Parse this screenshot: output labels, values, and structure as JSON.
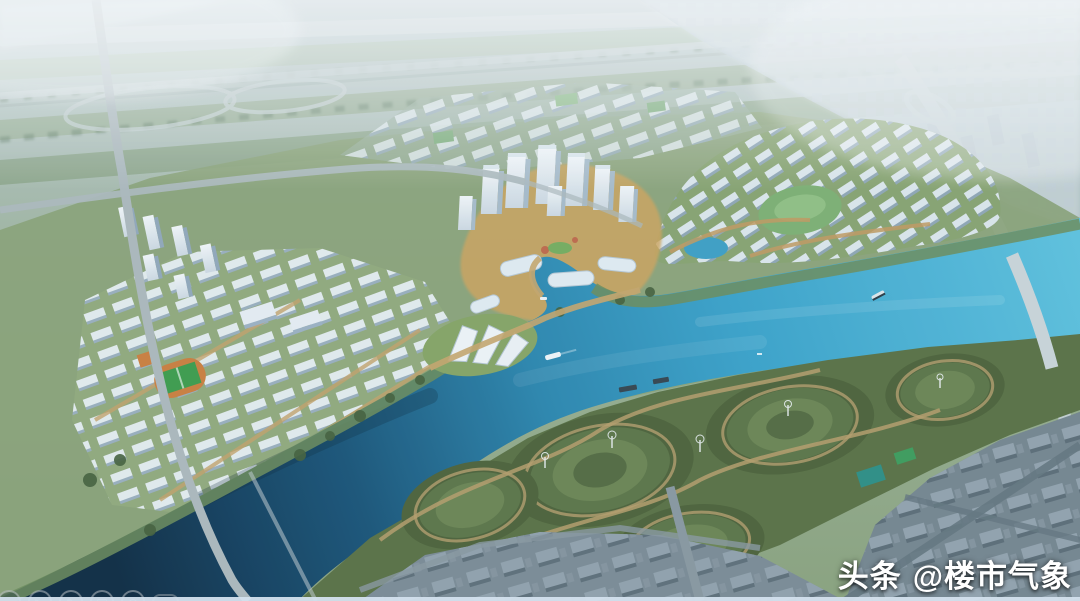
{
  "scene": {
    "description": "Aerial rendering of a riverside new-town masterplan: white residential clusters and a CBD tower group on the north bank, a wide cyan river with boats, a terraced green park and existing grey city blocks on the south bank, hazy farmland and distant city on the horizon",
    "palette": {
      "haze": "#c3cfd4",
      "distant_fields": "#9cb199",
      "river_bright": "#4fb5d8",
      "river_dark": "#102c42",
      "park_green": "#5b7144",
      "building_white": "#eef3f6",
      "plaza_tan": "#d2a55c",
      "city_grey": "#8c9ba5",
      "pitch_green": "#3f9c4b",
      "track_orange": "#cd7f3e"
    },
    "features": [
      "distant-farmland",
      "railway-corridor",
      "highway-interchange",
      "left-residential-cluster",
      "football-pitch",
      "cbd-towers",
      "waterfront-culture-center",
      "central-lagoon",
      "river",
      "boats",
      "bridge",
      "terraced-riverside-park",
      "wind-turbines",
      "existing-city-blocks"
    ]
  },
  "watermark": {
    "brand": "头条",
    "handle": "@楼市气象",
    "color": "#ffffff"
  },
  "overlay_toolbar": {
    "icons": [
      {
        "name": "back-icon",
        "glyph": "◅"
      },
      {
        "name": "play-icon",
        "glyph": "▷"
      },
      {
        "name": "pencil-icon",
        "glyph": "✎"
      },
      {
        "name": "frame-icon",
        "glyph": "▣"
      },
      {
        "name": "magnifier-icon",
        "glyph": "◎"
      },
      {
        "name": "badge-icon",
        "glyph": ""
      }
    ]
  }
}
